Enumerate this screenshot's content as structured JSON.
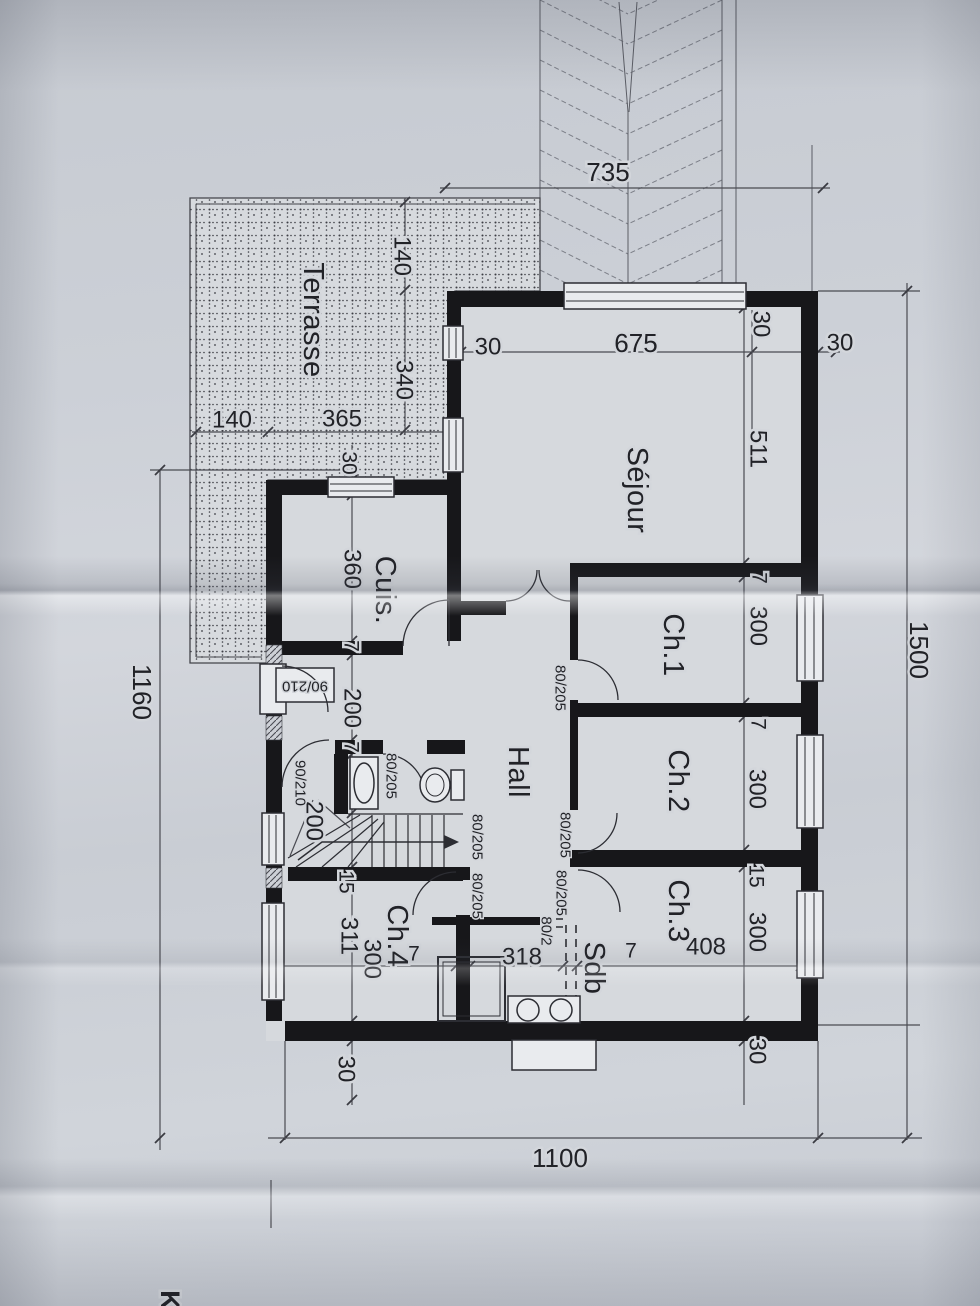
{
  "plan": {
    "rooms": {
      "terrasse": "Terrasse",
      "sejour": "Séjour",
      "cuisine": "Cuis.",
      "hall": "Hall",
      "ch1": "Ch.1",
      "ch2": "Ch.2",
      "ch3": "Ch.3",
      "ch4": "Ch.4",
      "sdb": "Sdb"
    },
    "dims": {
      "n735": "735",
      "n675": "675",
      "n511": "511",
      "n1500": "1500",
      "n1160": "1160",
      "n1100": "1100",
      "n365": "365",
      "n360": "360",
      "n340": "340",
      "n318": "318",
      "n311": "311",
      "n408": "408",
      "n300": "300",
      "n200": "200",
      "n140": "140",
      "n30": "30",
      "n15": "15",
      "n7": "7"
    },
    "door_sizes": {
      "entry": "90/210",
      "interior": "80/205",
      "interior_partial": "80/2"
    },
    "page_edge_text": "K"
  }
}
